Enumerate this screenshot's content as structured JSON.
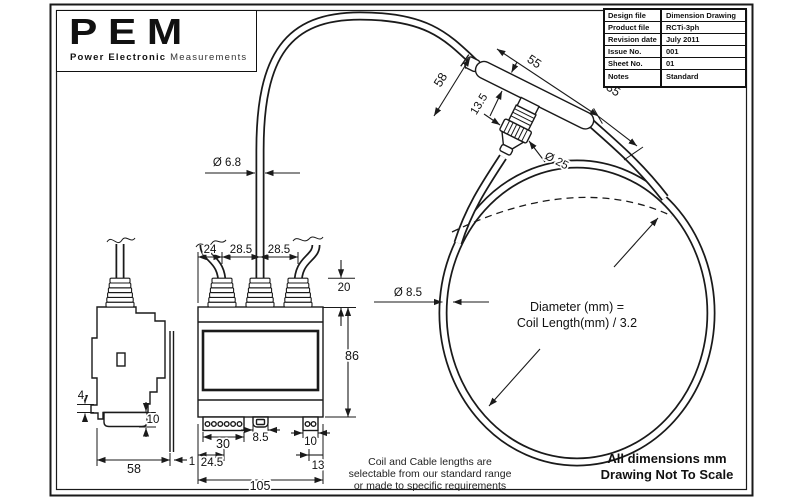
{
  "logo": {
    "text": "PEM",
    "tagline_bold": "Power Electronic",
    "tagline_light": "Measurements"
  },
  "title_block": {
    "rows": [
      {
        "label": "Design file",
        "value": "Dimension Drawing"
      },
      {
        "label": "Product file",
        "value": "RCTi-3ph"
      },
      {
        "label": "Revision date",
        "value": "July 2011"
      },
      {
        "label": "Issue No.",
        "value": "001"
      },
      {
        "label": "Sheet No.",
        "value": "01"
      },
      {
        "label": "Notes",
        "value": "Standard"
      }
    ]
  },
  "dims": {
    "cable_diameter": "Ø 6.8",
    "coil_tube_diameter": "Ø 8.5",
    "connector_diameter": "Ø 25",
    "body_length": "55",
    "body_tail": "35",
    "neck_length": "58",
    "body_width": "13.5",
    "gland_pitch_1": "24",
    "gland_pitch_2": "28.5",
    "gland_pitch_3": "28.5",
    "gland_height": "20",
    "case_height": "86",
    "terminal_block_width": "30",
    "mid_connector_width": "8.5",
    "aux_terminal_width": "10",
    "terminal_offset_left": "24.5",
    "terminal_offset_right": "13",
    "case_width": "105",
    "side_depth": "58",
    "rail_gap": "1",
    "clip_step": "4",
    "foot_height": "10"
  },
  "formula": {
    "line1": "Diameter (mm) =",
    "line2": "Coil Length(mm) / 3.2"
  },
  "coil_note": {
    "line1": "Coil and Cable lengths are",
    "line2": "selectable from our standard range",
    "line3": "or made to specific requirements"
  },
  "footer": {
    "line1": "All dimensions mm",
    "line2": "Drawing Not To Scale"
  }
}
